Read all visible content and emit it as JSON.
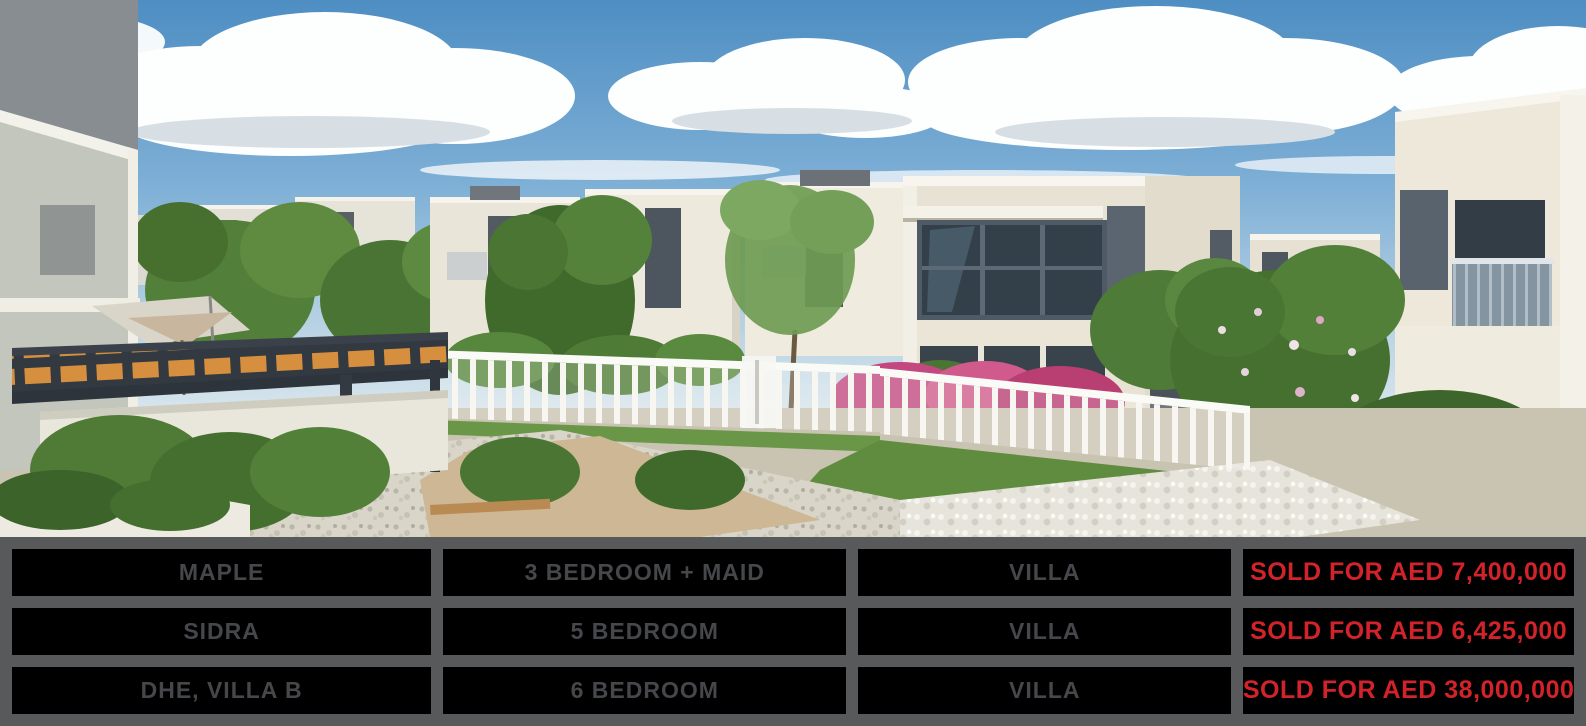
{
  "table": {
    "border_color": "#58595B",
    "cell_background": "#000000",
    "label_text_color": "#46474B",
    "price_text_color": "#D2232A",
    "rows": [
      {
        "community": "MAPLE",
        "layout": "3 BEDROOM + MAID",
        "type": "VILLA",
        "status": "SOLD FOR AED 7,400,000"
      },
      {
        "community": "SIDRA",
        "layout": "5 BEDROOM",
        "type": "VILLA",
        "status": "SOLD FOR AED 6,425,000"
      },
      {
        "community": "DHE, VILLA B",
        "layout": "6 BEDROOM",
        "type": "VILLA",
        "status": "SOLD FOR AED 38,000,000"
      }
    ]
  }
}
